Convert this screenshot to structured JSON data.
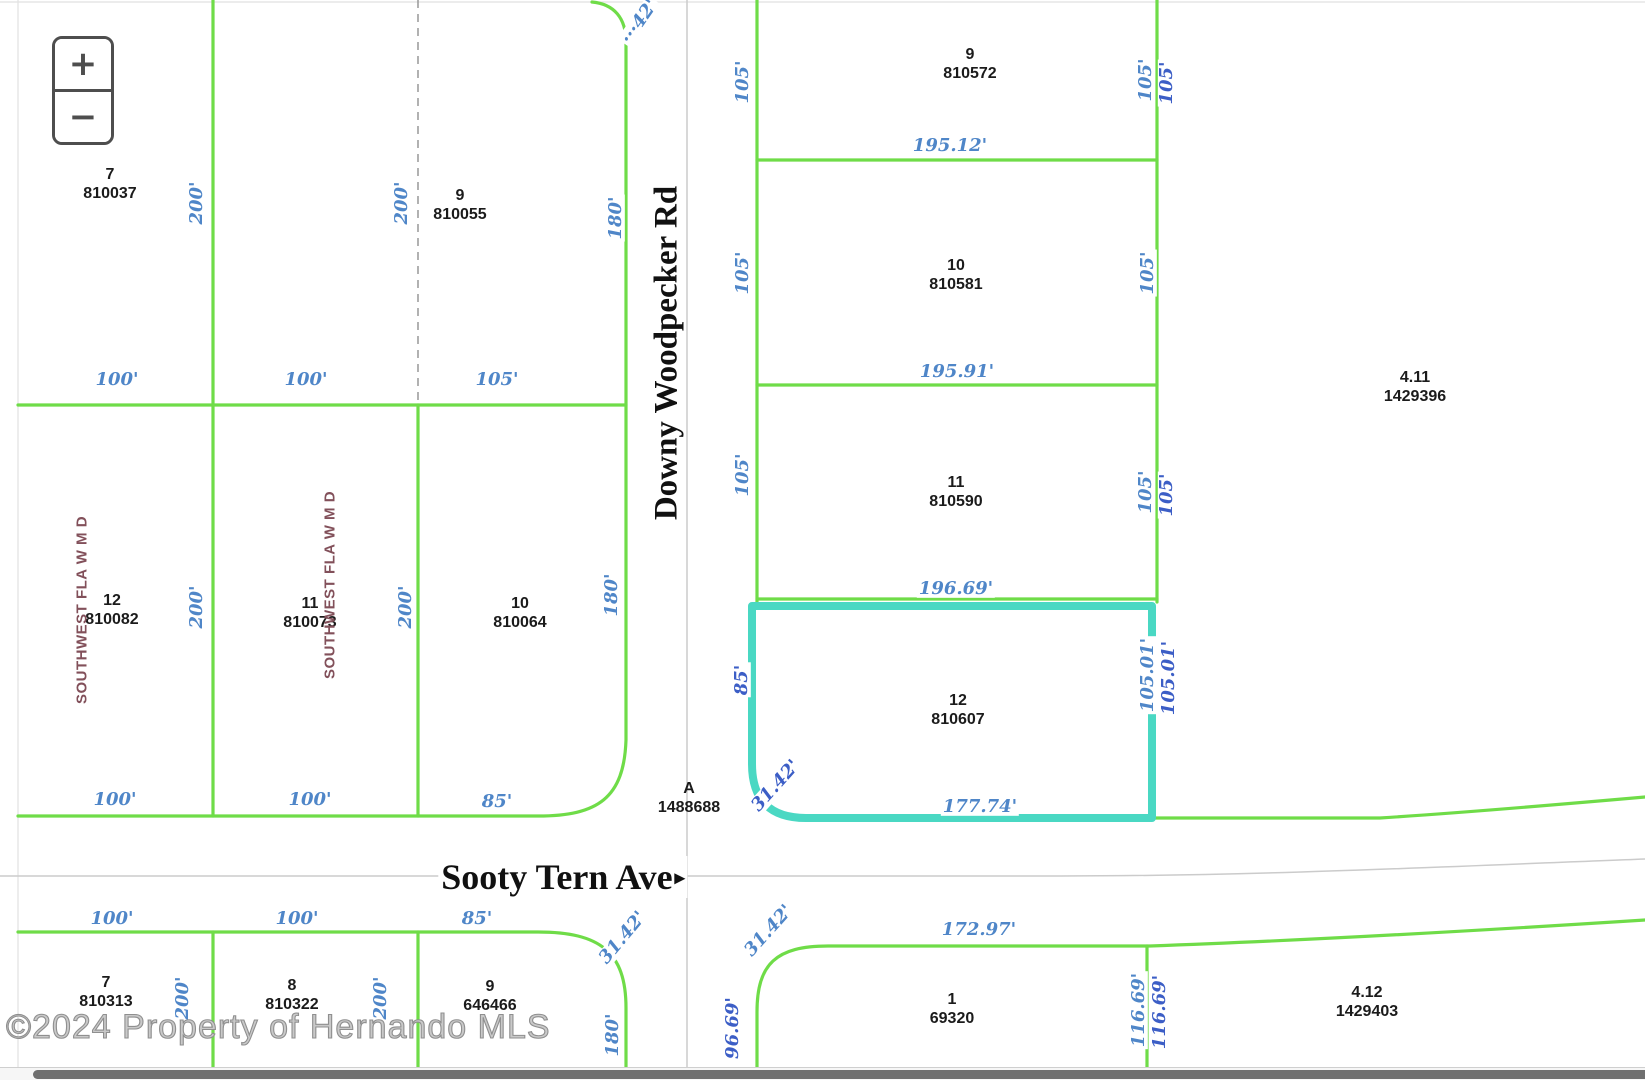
{
  "colors": {
    "green": "#6fdc48",
    "teal": "#4ad8c3",
    "dim_light": "#4f86c8",
    "dim_dark": "#3c5ec6",
    "maroon": "#82505a"
  },
  "zoom_control": {
    "zoom_in": "+",
    "zoom_out": "−"
  },
  "roads": [
    {
      "name": "Downy Woodpecker Rd",
      "x": 667,
      "y": 353,
      "rot": -90,
      "size": 33,
      "arrow": ""
    },
    {
      "name": "Sooty Tern Ave",
      "x": 563,
      "y": 877,
      "rot": 0,
      "size": 36,
      "arrow": "▸"
    }
  ],
  "district_labels": [
    {
      "text": "SOUTHWEST FLA W M D",
      "x": 82,
      "y": 610,
      "rot": -90
    },
    {
      "text": "SOUTHWEST FLA W M D",
      "x": 330,
      "y": 585,
      "rot": -90
    }
  ],
  "parcels": [
    {
      "lot": "7",
      "parcel": "810037",
      "x": 110,
      "y": 184
    },
    {
      "lot": "9",
      "parcel": "810055",
      "x": 460,
      "y": 205
    },
    {
      "lot": "12",
      "parcel": "810082",
      "x": 112,
      "y": 610
    },
    {
      "lot": "11",
      "parcel": "810073",
      "x": 310,
      "y": 613
    },
    {
      "lot": "10",
      "parcel": "810064",
      "x": 520,
      "y": 613
    },
    {
      "lot": "9",
      "parcel": "810572",
      "x": 970,
      "y": 64
    },
    {
      "lot": "10",
      "parcel": "810581",
      "x": 956,
      "y": 275
    },
    {
      "lot": "11",
      "parcel": "810590",
      "x": 956,
      "y": 492
    },
    {
      "lot": "12",
      "parcel": "810607",
      "x": 958,
      "y": 710
    },
    {
      "lot": "4.11",
      "parcel": "1429396",
      "x": 1415,
      "y": 387
    },
    {
      "lot": "1",
      "parcel": "69320",
      "x": 952,
      "y": 1009
    },
    {
      "lot": "4.12",
      "parcel": "1429403",
      "x": 1367,
      "y": 1002
    },
    {
      "lot": "7",
      "parcel": "810313",
      "x": 106,
      "y": 992
    },
    {
      "lot": "8",
      "parcel": "810322",
      "x": 292,
      "y": 995
    },
    {
      "lot": "9",
      "parcel": "646466",
      "x": 490,
      "y": 996
    },
    {
      "lot": "A",
      "parcel": "1488688",
      "x": 689,
      "y": 798
    }
  ],
  "dimensions": [
    {
      "text": "200'",
      "x": 197,
      "y": 203,
      "rot": -90,
      "tone": "a"
    },
    {
      "text": "200'",
      "x": 402,
      "y": 203,
      "rot": -90,
      "tone": "a"
    },
    {
      "text": "180'",
      "x": 616,
      "y": 218,
      "rot": -90,
      "tone": "a"
    },
    {
      "text": "100'",
      "x": 117,
      "y": 380,
      "rot": 0,
      "tone": "a"
    },
    {
      "text": "100'",
      "x": 306,
      "y": 380,
      "rot": 0,
      "tone": "a"
    },
    {
      "text": "105'",
      "x": 497,
      "y": 380,
      "rot": 0,
      "tone": "a"
    },
    {
      "text": "200'",
      "x": 197,
      "y": 607,
      "rot": -90,
      "tone": "a"
    },
    {
      "text": "200'",
      "x": 406,
      "y": 607,
      "rot": -90,
      "tone": "a"
    },
    {
      "text": "180'",
      "x": 612,
      "y": 595,
      "rot": -90,
      "tone": "a"
    },
    {
      "text": "100'",
      "x": 115,
      "y": 800,
      "rot": 0,
      "tone": "a"
    },
    {
      "text": "100'",
      "x": 310,
      "y": 800,
      "rot": 0,
      "tone": "a"
    },
    {
      "text": "85'",
      "x": 497,
      "y": 802,
      "rot": 0,
      "tone": "a"
    },
    {
      "text": "···42'",
      "x": 640,
      "y": 22,
      "rot": -55,
      "tone": "a"
    },
    {
      "text": "105'",
      "x": 743,
      "y": 82,
      "rot": -90,
      "tone": "a"
    },
    {
      "text": "105'",
      "x": 743,
      "y": 273,
      "rot": -90,
      "tone": "a"
    },
    {
      "text": "105'",
      "x": 743,
      "y": 475,
      "rot": -90,
      "tone": "a"
    },
    {
      "text": "85'",
      "x": 742,
      "y": 680,
      "rot": -90,
      "tone": "b"
    },
    {
      "text": "105'",
      "x": 1146,
      "y": 80,
      "rot": -90,
      "tone": "a"
    },
    {
      "text": "105'",
      "x": 1167,
      "y": 83,
      "rot": -90,
      "tone": "b"
    },
    {
      "text": "105'",
      "x": 1148,
      "y": 273,
      "rot": -90,
      "tone": "a"
    },
    {
      "text": "105'",
      "x": 1146,
      "y": 492,
      "rot": -90,
      "tone": "a"
    },
    {
      "text": "105'",
      "x": 1167,
      "y": 495,
      "rot": -90,
      "tone": "b"
    },
    {
      "text": "105.01'",
      "x": 1148,
      "y": 675,
      "rot": -90,
      "tone": "a"
    },
    {
      "text": "105.01'",
      "x": 1169,
      "y": 678,
      "rot": -90,
      "tone": "b"
    },
    {
      "text": "195.12'",
      "x": 950,
      "y": 146,
      "rot": 0,
      "tone": "a"
    },
    {
      "text": "195.91'",
      "x": 957,
      "y": 372,
      "rot": 0,
      "tone": "a"
    },
    {
      "text": "196.69'",
      "x": 956,
      "y": 589,
      "rot": 0,
      "tone": "a"
    },
    {
      "text": "177.74'",
      "x": 980,
      "y": 807,
      "rot": 0,
      "tone": "a"
    },
    {
      "text": "172.97'",
      "x": 979,
      "y": 930,
      "rot": 0,
      "tone": "a"
    },
    {
      "text": "31.42'",
      "x": 776,
      "y": 786,
      "rot": -48,
      "tone": "b"
    },
    {
      "text": "31.42'",
      "x": 623,
      "y": 938,
      "rot": -50,
      "tone": "a"
    },
    {
      "text": "31.42'",
      "x": 769,
      "y": 931,
      "rot": -48,
      "tone": "a"
    },
    {
      "text": "100'",
      "x": 112,
      "y": 919,
      "rot": 0,
      "tone": "a"
    },
    {
      "text": "100'",
      "x": 297,
      "y": 919,
      "rot": 0,
      "tone": "a"
    },
    {
      "text": "85'",
      "x": 477,
      "y": 919,
      "rot": 0,
      "tone": "a"
    },
    {
      "text": "200'",
      "x": 183,
      "y": 998,
      "rot": -90,
      "tone": "a"
    },
    {
      "text": "200'",
      "x": 381,
      "y": 998,
      "rot": -90,
      "tone": "a"
    },
    {
      "text": "180'",
      "x": 613,
      "y": 1035,
      "rot": -90,
      "tone": "a"
    },
    {
      "text": "96.69'",
      "x": 733,
      "y": 1028,
      "rot": -90,
      "tone": "b"
    },
    {
      "text": "116.69'",
      "x": 1139,
      "y": 1010,
      "rot": -90,
      "tone": "a"
    },
    {
      "text": "116.69'",
      "x": 1160,
      "y": 1012,
      "rot": -90,
      "tone": "b"
    }
  ],
  "watermark": "©2024 Property of Hernando MLS"
}
